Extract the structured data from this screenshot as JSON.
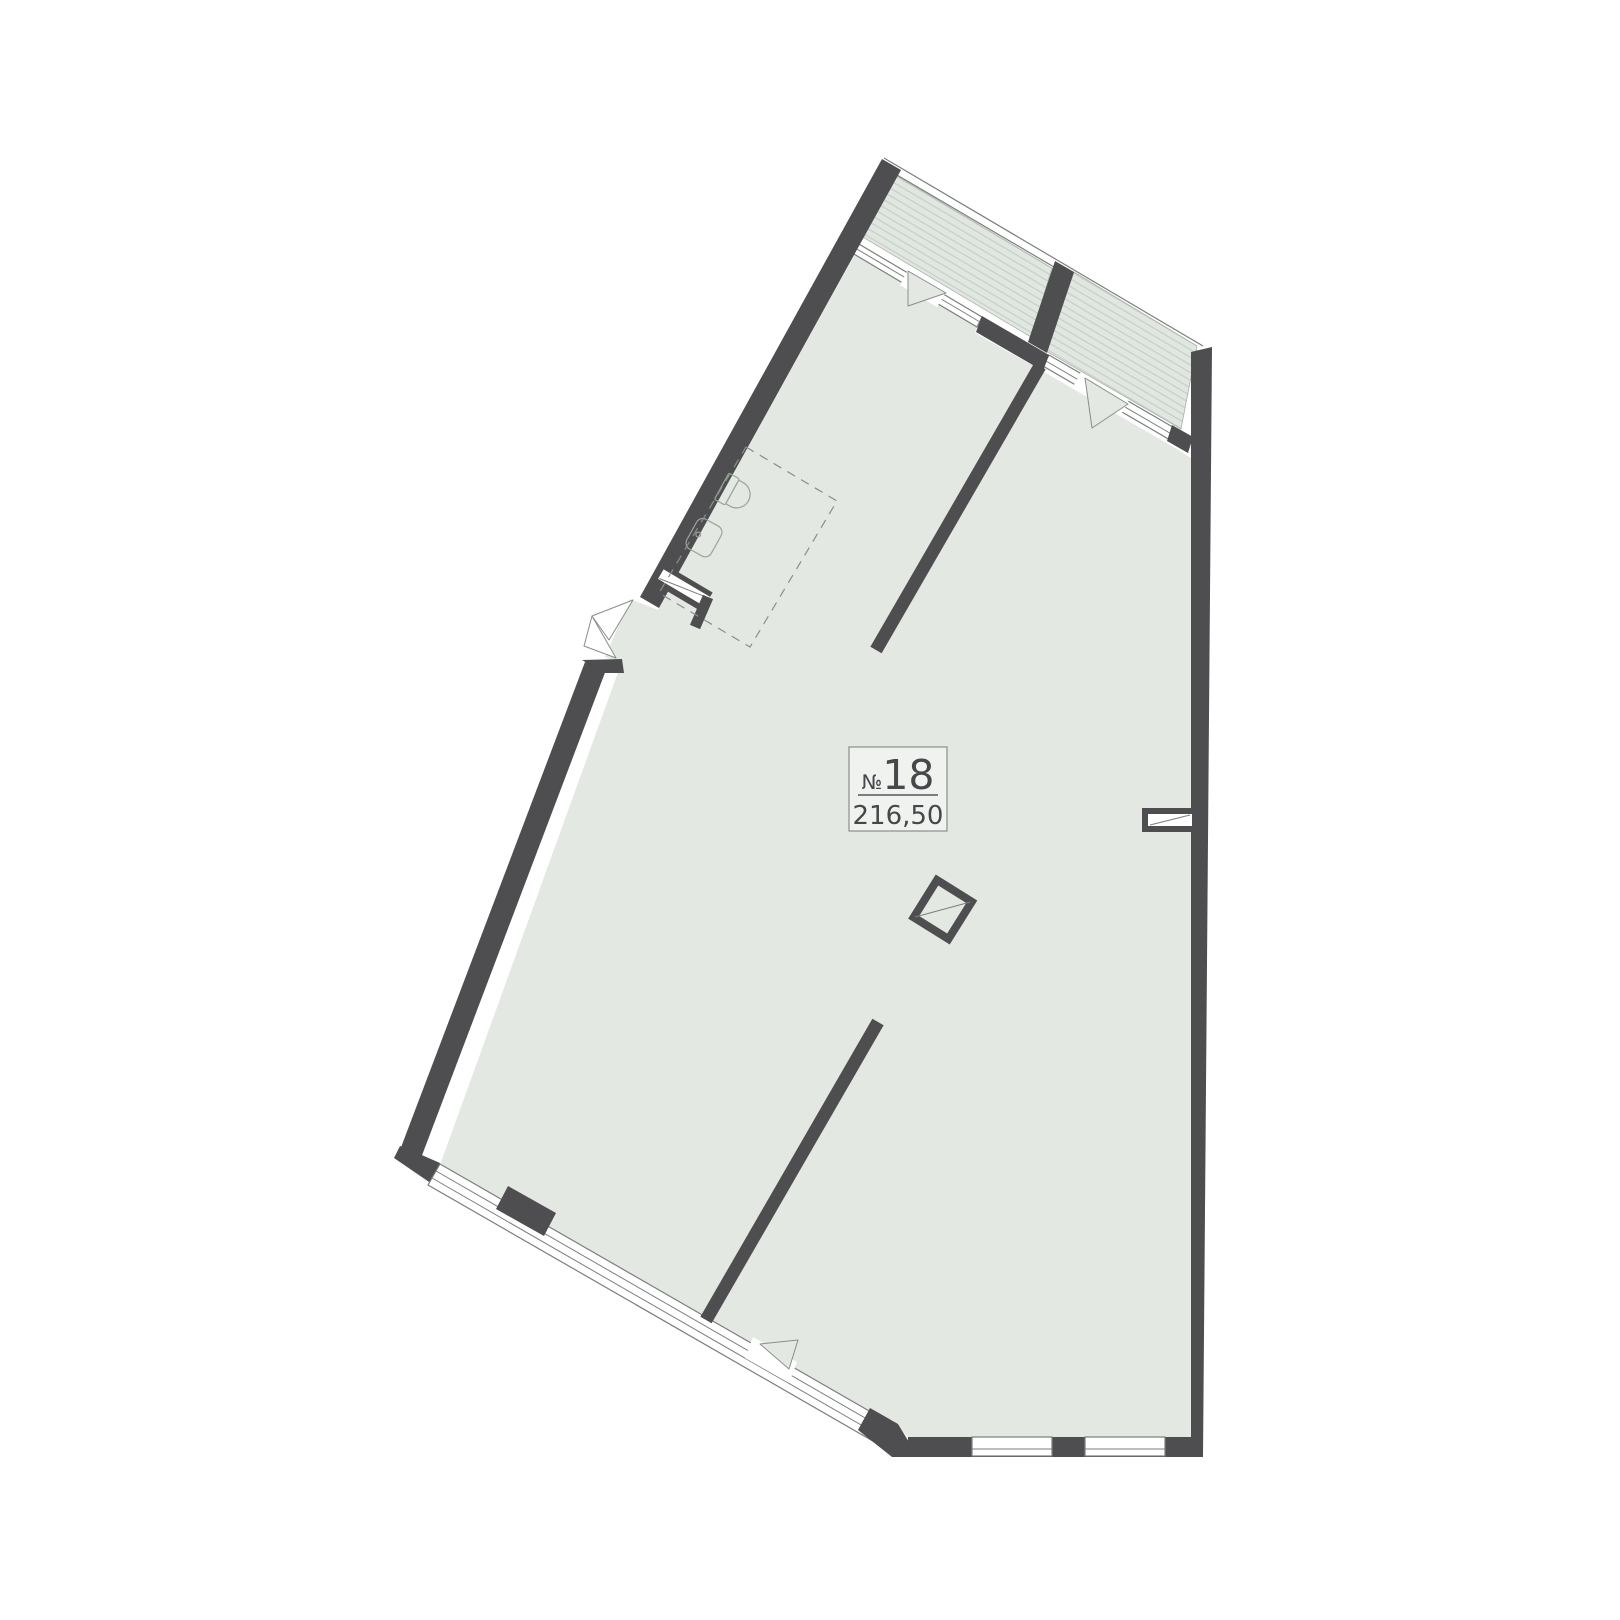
{
  "unit_label": {
    "number_prefix": "№",
    "number": "18",
    "area": "216,50"
  },
  "colors": {
    "wall": "#4e4e50",
    "floor": "#e3e8e2",
    "hatch_background": "#e0e6e0",
    "hatch_stripe": "#c8d0c8",
    "outline": "#7b7f7c",
    "fixture_outline": "#9aa59c",
    "label_text": "#47474b",
    "background": "#ffffff"
  }
}
